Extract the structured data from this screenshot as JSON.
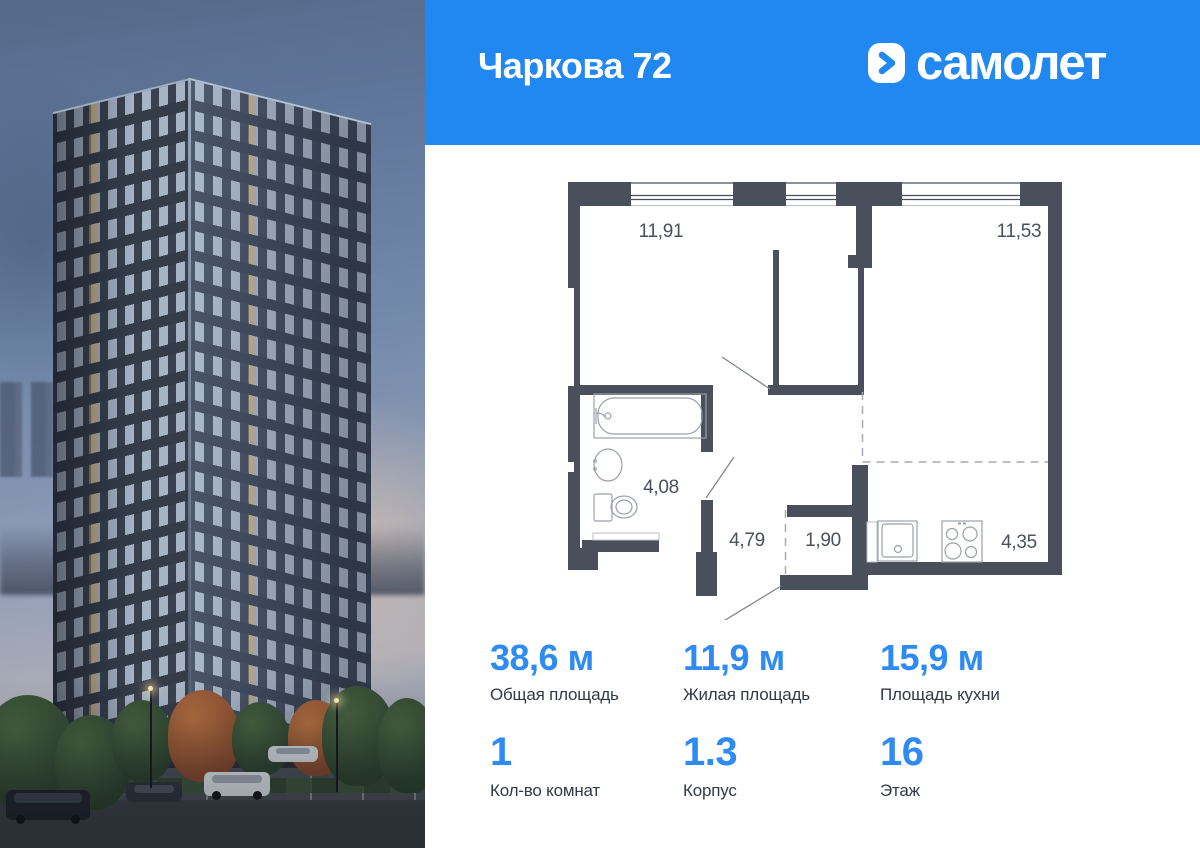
{
  "header": {
    "title": "Чаркова 72",
    "brand": "самолет"
  },
  "plan": {
    "rooms": [
      {
        "name": "living-room",
        "area": "11,91"
      },
      {
        "name": "kitchen-living-room",
        "area": "11,53"
      },
      {
        "name": "bathroom",
        "area": "4,08"
      },
      {
        "name": "hallway",
        "area": "4,79"
      },
      {
        "name": "wardrobe",
        "area": "1,90"
      },
      {
        "name": "kitchen-zone",
        "area": "4,35"
      }
    ]
  },
  "stats": {
    "row1": [
      {
        "value": "38,6 м",
        "label": "Общая площадь"
      },
      {
        "value": "11,9 м",
        "label": "Жилая площадь"
      },
      {
        "value": "15,9 м",
        "label": "Площадь кухни"
      }
    ],
    "row2": [
      {
        "value": "1",
        "label": "Кол-во комнат"
      },
      {
        "value": "1.3",
        "label": "Корпус"
      },
      {
        "value": "16",
        "label": "Этаж"
      }
    ]
  },
  "colors": {
    "header_bg": "#2187f1",
    "accent": "#2e8bf2",
    "wall": "#4a4f5b"
  }
}
